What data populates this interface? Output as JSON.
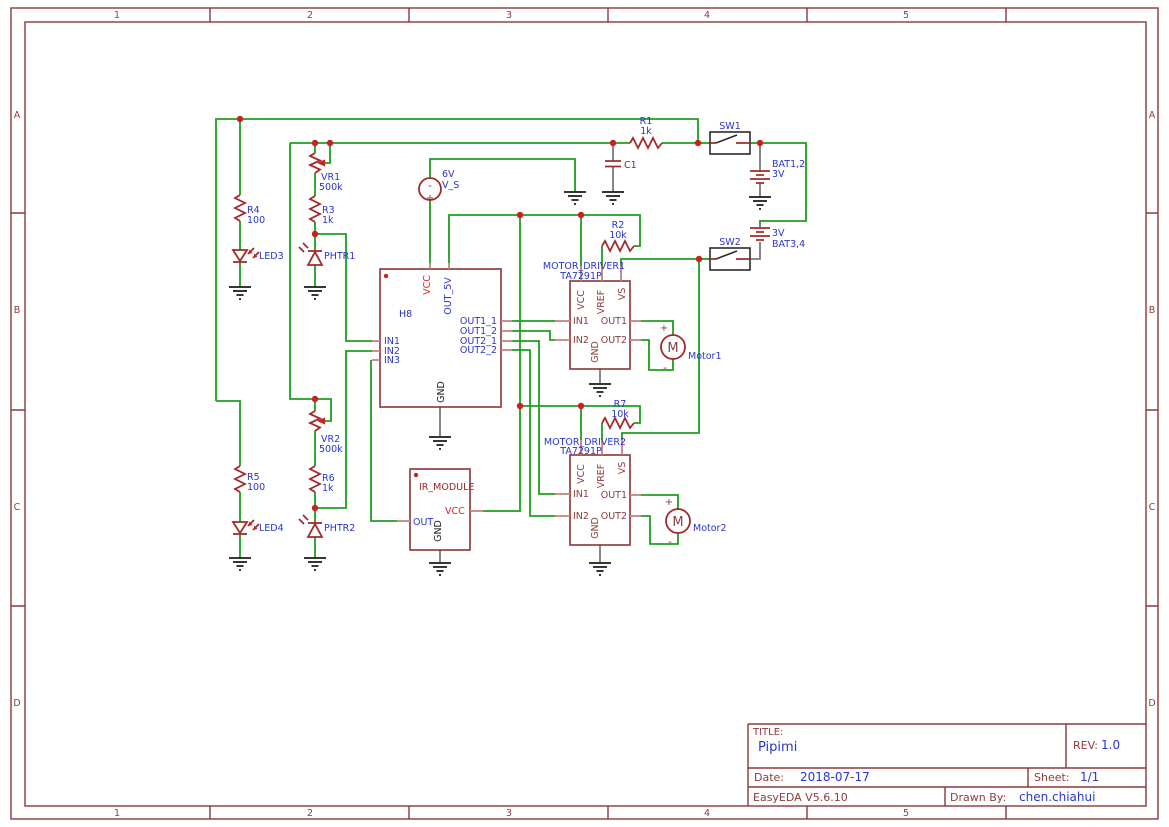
{
  "frame": {
    "cols": [
      "1",
      "2",
      "3",
      "4",
      "5"
    ],
    "rows": [
      "A",
      "B",
      "C",
      "D"
    ]
  },
  "title_block": {
    "title_label": "TITLE:",
    "title": "Pipimi",
    "rev_label": "REV:",
    "rev": "1.0",
    "date_label": "Date:",
    "date": "2018-07-17",
    "sheet_label": "Sheet:",
    "sheet": "1/1",
    "tool": "EasyEDA V5.6.10",
    "drawn_by_label": "Drawn By:",
    "drawn_by": "chen.chiahui"
  },
  "parts": {
    "sw1": "SW1",
    "sw2": "SW2",
    "r1": "R1",
    "r1_v": "1k",
    "r2": "R2",
    "r2_v": "10k",
    "r3": "R3",
    "r3_v": "1k",
    "r4": "R4",
    "r4_v": "100",
    "r5": "R5",
    "r5_v": "100",
    "r6": "R6",
    "r6_v": "1k",
    "r7": "R7",
    "r7_v": "10k",
    "vr1": "VR1",
    "vr1_v": "500k",
    "vr2": "VR2",
    "vr2_v": "500k",
    "c1": "C1",
    "bat12": "BAT1,2",
    "bat12_v": "3V",
    "bat34": "BAT3,4",
    "bat34_v": "3V",
    "led3": "LED3",
    "led4": "LED4",
    "phtr1": "PHTR1",
    "phtr2": "PHTR2",
    "vs_v": "6V",
    "vs_ref": "V_S",
    "h8": "H8",
    "md1": "MOTOR_DRIVER1",
    "md2": "MOTOR_DRIVER2",
    "ta": "TA7291P",
    "ir": "IR_MODULE",
    "motor1": "Motor1",
    "motor2": "Motor2",
    "m": "M",
    "plus": "+",
    "minus": "-"
  },
  "h8_pins": {
    "vcc": "VCC",
    "out5v": "OUT_5V",
    "in1": "IN1",
    "in2": "IN2",
    "in3": "IN3",
    "o11": "OUT1_1",
    "o12": "OUT1_2",
    "o21": "OUT2_1",
    "o22": "OUT2_2",
    "gnd": "GND"
  },
  "drv_pins": {
    "vcc": "VCC",
    "vref": "VREF",
    "vs": "VS",
    "in1": "IN1",
    "in2": "IN2",
    "out1": "OUT1",
    "out2": "OUT2",
    "gnd": "GND"
  },
  "ir_pins": {
    "out": "OUT",
    "vcc": "VCC",
    "gnd": "GND"
  },
  "colors": {
    "wire": "#1E9E1E",
    "symbol": "#A22A2A",
    "frame": "#8C3838",
    "label_blue": "#2A35CC",
    "pin_red": "#E02020",
    "junction": "#CC2020"
  }
}
